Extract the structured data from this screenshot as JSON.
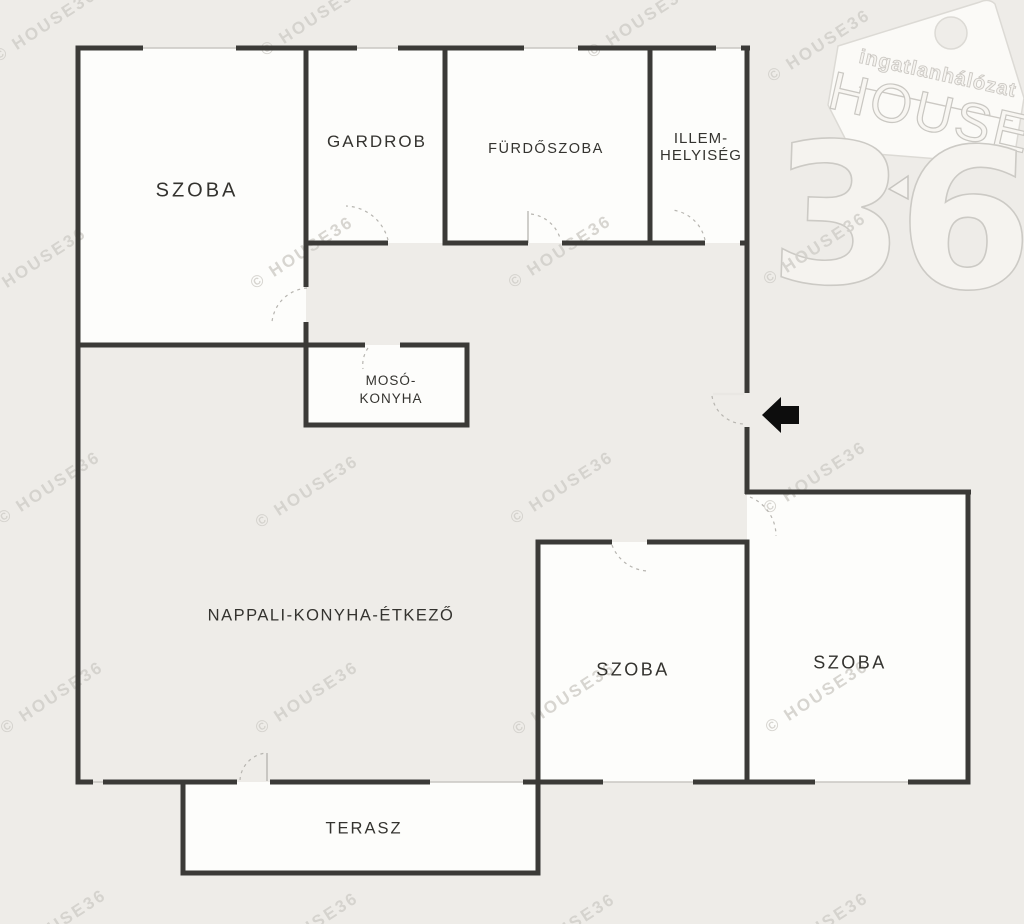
{
  "plan": {
    "type": "floor-plan",
    "rooms": [
      {
        "name": "szoba-top-left",
        "lines": [
          "SZOBA"
        ]
      },
      {
        "name": "gardrob",
        "lines": [
          "GARDROB"
        ]
      },
      {
        "name": "furdoszoba",
        "lines": [
          "FÜRDŐSZOBA"
        ]
      },
      {
        "name": "illemhelyiseg",
        "lines": [
          "ILLEM-",
          "HELYISÉG"
        ]
      },
      {
        "name": "mosokonyha",
        "lines": [
          "MOSÓ-",
          "KONYHA"
        ]
      },
      {
        "name": "nappali-konyha-etkezo",
        "lines": [
          "NAPPALI-KONYHA-ÉTKEZŐ"
        ]
      },
      {
        "name": "szoba-bottom-left",
        "lines": [
          "SZOBA"
        ]
      },
      {
        "name": "szoba-bottom-right",
        "lines": [
          "SZOBA"
        ]
      },
      {
        "name": "terasz",
        "lines": [
          "TERASZ"
        ]
      }
    ]
  },
  "watermark": {
    "text": "© HOUSE36",
    "positions": [
      [
        48,
        30
      ],
      [
        315,
        24
      ],
      [
        642,
        26
      ],
      [
        822,
        50
      ],
      [
        38,
        268
      ],
      [
        305,
        257
      ],
      [
        563,
        256
      ],
      [
        818,
        253
      ],
      [
        52,
        492
      ],
      [
        310,
        496
      ],
      [
        565,
        492
      ],
      [
        818,
        482
      ],
      [
        55,
        702
      ],
      [
        310,
        702
      ],
      [
        567,
        703
      ],
      [
        820,
        701
      ],
      [
        58,
        930
      ],
      [
        310,
        933
      ],
      [
        567,
        934
      ],
      [
        820,
        933
      ]
    ]
  },
  "logo": {
    "brand_small": "ingatlanhálózat",
    "brand_word": "HOUSE",
    "brand_number": "36"
  },
  "colors": {
    "background": "#eeece8",
    "room_fill": "#fdfdfb",
    "wall": "#3b3a37",
    "label_text": "#34332f",
    "watermark": "#d3d1cc",
    "arrow": "#0d0d0d",
    "logo_outline": "#ccc9c4"
  }
}
